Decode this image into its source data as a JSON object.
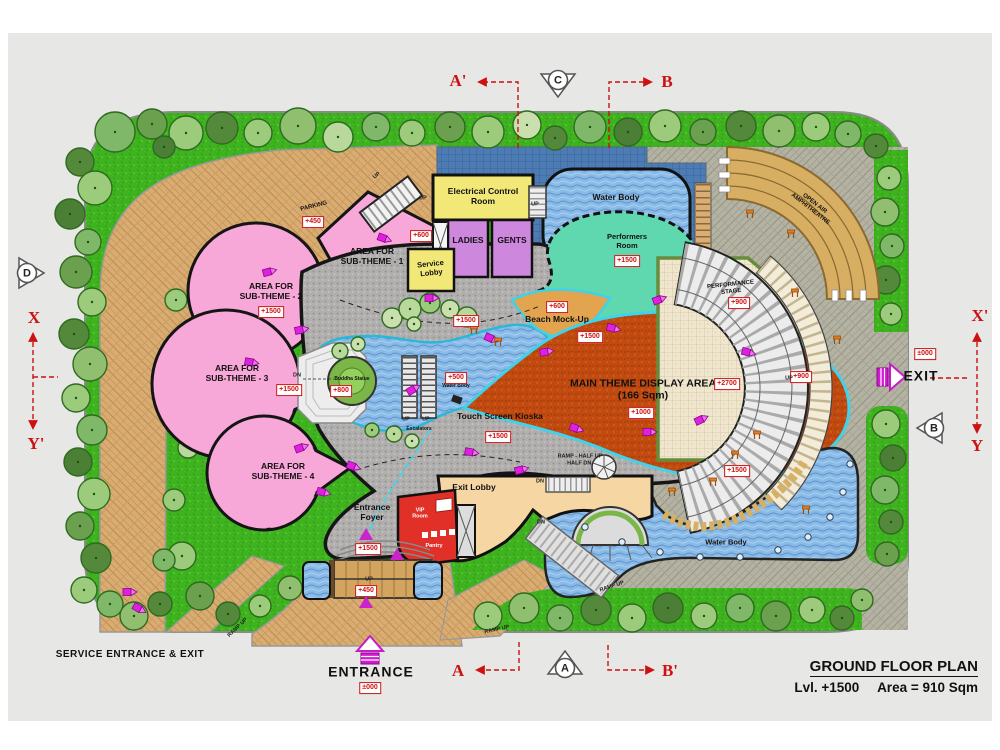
{
  "title_block": {
    "title": "GROUND FLOOR PLAN",
    "level": "Lvl. +1500",
    "area": "Area = 910 Sqm"
  },
  "colors": {
    "marker_red": "#cc1111",
    "lawn_green": "#3fb31f",
    "water_blue": "#8abbe8",
    "subtheme_pink": "#f8a8d8",
    "display_orange": "#c14a10",
    "road_tan": "#d9ac72"
  },
  "labels": [
    {
      "name": "electrical-control-room-label",
      "text": "Electrical Control\nRoom",
      "x": 483,
      "y": 196,
      "cls": "lbl-md"
    },
    {
      "name": "ladies-room-label",
      "text": "LADIES",
      "x": 468,
      "y": 240,
      "cls": "lbl-md"
    },
    {
      "name": "gents-room-label",
      "text": "GENTS",
      "x": 512,
      "y": 240,
      "cls": "lbl-md"
    },
    {
      "name": "service-lobby-label",
      "text": "Service\nLobby",
      "x": 431,
      "y": 269,
      "cls": "lbl-sm",
      "rot": -6
    },
    {
      "name": "top-water-body-label",
      "text": "Water Body",
      "x": 616,
      "y": 197,
      "cls": "lbl-md"
    },
    {
      "name": "performers-room-label",
      "text": "Performers\nRoom",
      "x": 627,
      "y": 242,
      "cls": "lbl-sm"
    },
    {
      "name": "sub-theme-1-label",
      "text": "AREA FOR\nSUB-THEME - 1",
      "x": 372,
      "y": 256,
      "cls": "lbl-md"
    },
    {
      "name": "sub-theme-2-label",
      "text": "AREA FOR\nSUB-THEME - 2",
      "x": 271,
      "y": 291,
      "cls": "lbl-md"
    },
    {
      "name": "sub-theme-3-label",
      "text": "AREA FOR\nSUB-THEME - 3",
      "x": 237,
      "y": 373,
      "cls": "lbl-md"
    },
    {
      "name": "sub-theme-4-label",
      "text": "AREA FOR\nSUB-THEME - 4",
      "x": 283,
      "y": 471,
      "cls": "lbl-md"
    },
    {
      "name": "parking-label",
      "text": "PARKING",
      "x": 314,
      "y": 207,
      "cls": "lbl-xs",
      "rot": -14
    },
    {
      "name": "beach-mockup-label",
      "text": "Beach Mock-Up",
      "x": 557,
      "y": 319,
      "cls": "lbl-md"
    },
    {
      "name": "main-theme-display-label",
      "text": "MAIN THEME DISPLAY AREA\n(166 Sqm)",
      "x": 643,
      "y": 390,
      "cls": "lbl-lg"
    },
    {
      "name": "touch-screen-kioska-label",
      "text": "Touch Screen Kioska",
      "x": 500,
      "y": 416,
      "cls": "lbl-md"
    },
    {
      "name": "entrance-foyer-label",
      "text": "Entrance\nFoyer",
      "x": 372,
      "y": 512,
      "cls": "lbl-md"
    },
    {
      "name": "exit-lobby-label",
      "text": "Exit Lobby",
      "x": 474,
      "y": 487,
      "cls": "lbl-md"
    },
    {
      "name": "vip-room-label",
      "text": "VIP\nRoom",
      "x": 420,
      "y": 514,
      "cls": "lbl-white"
    },
    {
      "name": "pantry-label",
      "text": "Pantry",
      "x": 434,
      "y": 546,
      "cls": "lbl-white"
    },
    {
      "name": "main-water-body-label",
      "text": "Water Body",
      "x": 726,
      "y": 543,
      "cls": "lbl-sm"
    },
    {
      "name": "stream-water-body-label",
      "text": "Water Body",
      "x": 456,
      "y": 387,
      "cls": "lbl-2xs"
    },
    {
      "name": "buddha-statue-label",
      "text": "Buddha Statue",
      "x": 352,
      "y": 380,
      "cls": "lbl-2xs"
    },
    {
      "name": "performance-stage-label",
      "text": "PERFORMANCE\nSTAGE",
      "x": 731,
      "y": 289,
      "cls": "lbl-xs",
      "rot": -6
    },
    {
      "name": "amphitheatre-label",
      "text": "OPEN AIR\nAMPHITHEATRE",
      "x": 812,
      "y": 207,
      "cls": "lbl-xs",
      "rot": 38
    },
    {
      "name": "escalators-label",
      "text": "Escalators",
      "x": 419,
      "y": 430,
      "cls": "lbl-2xs"
    },
    {
      "name": "service-entrance-exit-label",
      "text": "SERVICE ENTRANCE & EXIT",
      "x": 130,
      "y": 655,
      "cls": "lbl-outer"
    },
    {
      "name": "entrance-label",
      "text": "ENTRANCE",
      "x": 371,
      "y": 672,
      "cls": "lbl-entrance"
    },
    {
      "name": "exit-label",
      "text": "EXIT",
      "x": 921,
      "y": 376,
      "cls": "lbl-entrance"
    }
  ],
  "badges": [
    {
      "v": "+450",
      "x": 313,
      "y": 222
    },
    {
      "v": "+1500",
      "x": 271,
      "y": 312
    },
    {
      "v": "+1500",
      "x": 289,
      "y": 390
    },
    {
      "v": "+600",
      "x": 421,
      "y": 236
    },
    {
      "v": "+800",
      "x": 341,
      "y": 391
    },
    {
      "v": "+500",
      "x": 456,
      "y": 378
    },
    {
      "v": "+1500",
      "x": 466,
      "y": 321
    },
    {
      "v": "+1500",
      "x": 590,
      "y": 337
    },
    {
      "v": "+600",
      "x": 557,
      "y": 307
    },
    {
      "v": "+1000",
      "x": 641,
      "y": 413
    },
    {
      "v": "+1500",
      "x": 498,
      "y": 437
    },
    {
      "v": "+1500",
      "x": 627,
      "y": 261
    },
    {
      "v": "+900",
      "x": 739,
      "y": 303
    },
    {
      "v": "+2700",
      "x": 727,
      "y": 384
    },
    {
      "v": "+900",
      "x": 801,
      "y": 377
    },
    {
      "v": "+1500",
      "x": 737,
      "y": 471
    },
    {
      "v": "+1500",
      "x": 368,
      "y": 549
    },
    {
      "v": "+450",
      "x": 366,
      "y": 591
    },
    {
      "v": "±000",
      "x": 925,
      "y": 354
    },
    {
      "v": "±000",
      "x": 370,
      "y": 688
    }
  ],
  "annotations": [
    {
      "t": "UP",
      "x": 423,
      "y": 199
    },
    {
      "t": "UP",
      "x": 535,
      "y": 205
    },
    {
      "t": "UP",
      "x": 406,
      "y": 420
    },
    {
      "t": "UP",
      "x": 426,
      "y": 420
    },
    {
      "t": "UP",
      "x": 369,
      "y": 580
    },
    {
      "t": "UP",
      "x": 789,
      "y": 379
    },
    {
      "t": "UP",
      "x": 377,
      "y": 176,
      "rot": -38
    },
    {
      "t": "DN",
      "x": 297,
      "y": 376
    },
    {
      "t": "DN",
      "x": 540,
      "y": 482
    },
    {
      "t": "DN",
      "x": 541,
      "y": 523
    },
    {
      "t": "RAMP UP",
      "x": 238,
      "y": 628,
      "rot": -44
    },
    {
      "t": "RAMP UP",
      "x": 497,
      "y": 630,
      "rot": -12
    },
    {
      "t": "RAMP UP",
      "x": 612,
      "y": 587,
      "rot": -18
    },
    {
      "t": "RAMP - HALF UP\nHALF DN.",
      "x": 580,
      "y": 460,
      "rot": 0
    }
  ],
  "section_letters": [
    {
      "t": "A'",
      "x": 458,
      "y": 81
    },
    {
      "t": "B",
      "x": 667,
      "y": 82
    },
    {
      "t": "X",
      "x": 34,
      "y": 318
    },
    {
      "t": "Y'",
      "x": 36,
      "y": 444
    },
    {
      "t": "X'",
      "x": 980,
      "y": 316
    },
    {
      "t": "Y",
      "x": 977,
      "y": 446
    },
    {
      "t": "A",
      "x": 458,
      "y": 671
    },
    {
      "t": "B'",
      "x": 670,
      "y": 671
    }
  ],
  "circle_markers": [
    {
      "t": "C",
      "x": 558,
      "y": 80,
      "dir": "down"
    },
    {
      "t": "D",
      "x": 27,
      "y": 273,
      "dir": "right"
    },
    {
      "t": "B",
      "x": 934,
      "y": 428,
      "dir": "left"
    },
    {
      "t": "A",
      "x": 565,
      "y": 668,
      "dir": "up"
    }
  ]
}
